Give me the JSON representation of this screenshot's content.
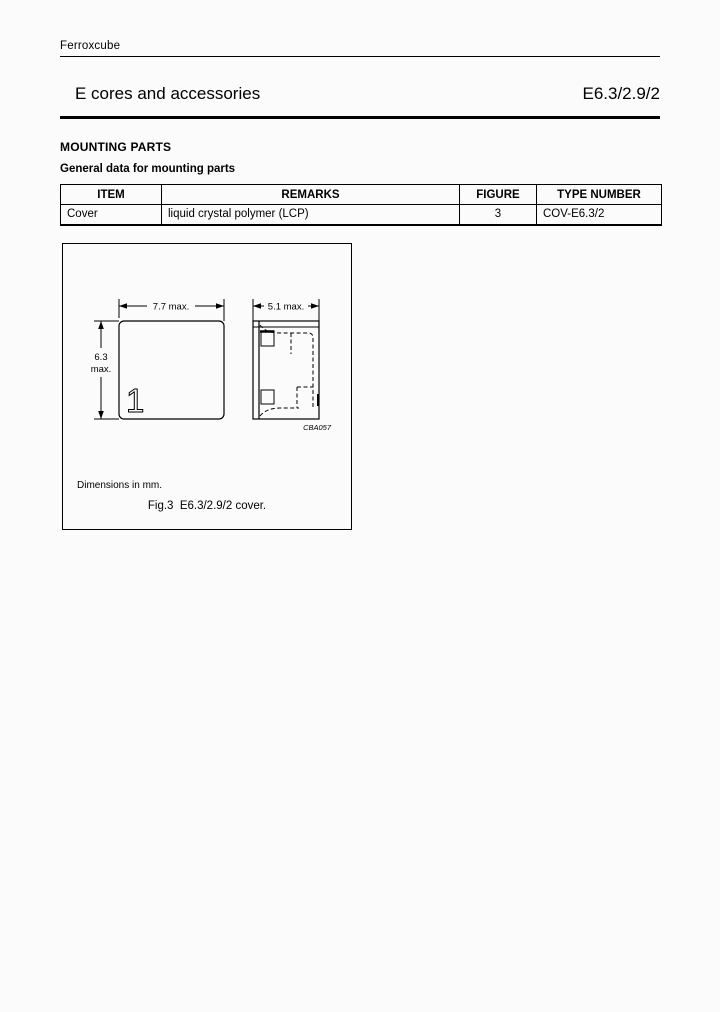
{
  "header": {
    "brand": "Ferroxcube",
    "title": "E cores and accessories",
    "part_number": "E6.3/2.9/2"
  },
  "section": {
    "heading": "MOUNTING PARTS",
    "subheading": "General data for mounting parts"
  },
  "table": {
    "headers": [
      "ITEM",
      "REMARKS",
      "FIGURE",
      "TYPE NUMBER"
    ],
    "rows": [
      [
        "Cover",
        "liquid crystal polymer (LCP)",
        "3",
        "COV-E6.3/2"
      ]
    ]
  },
  "figure": {
    "dim_front_width": "7.7 max.",
    "dim_front_height_value": "6.3",
    "dim_front_height_suffix": "max.",
    "dim_side_width": "5.1 max.",
    "front_marking": "1",
    "drawing_code": "CBA057",
    "note": "Dimensions in mm.",
    "caption": "Fig.3  E6.3/2.9/2 cover."
  },
  "colors": {
    "ink": "#000000",
    "paper": "#fbfbfb"
  }
}
